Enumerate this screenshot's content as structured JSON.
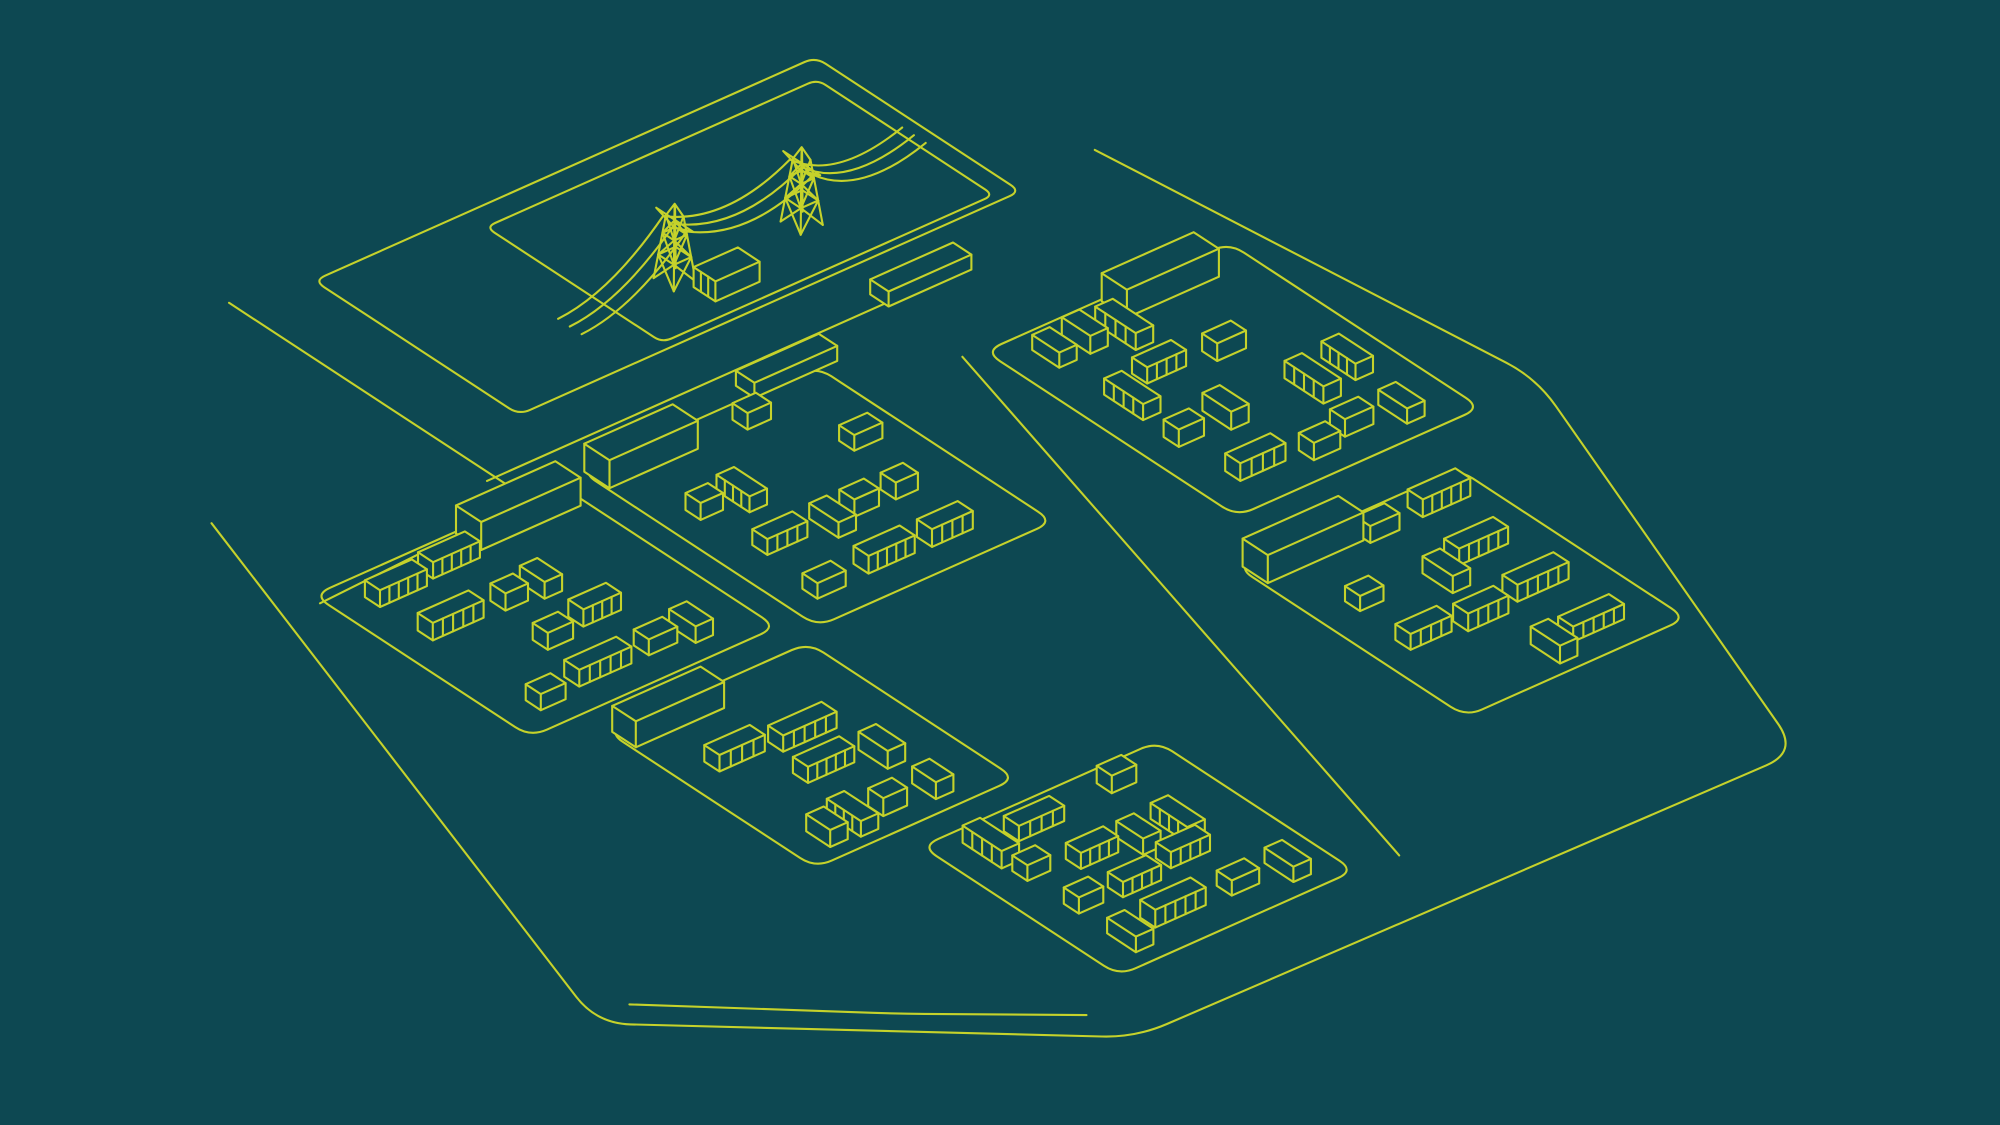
{
  "scene": {
    "width": 2000,
    "height": 1125,
    "background_color": "#0D4852",
    "line_color": "#C5D22B",
    "stroke_width": 2.1,
    "description": "Isometric line illustration of a housing development site with electricity pylons, substation, roads and six housing parcels"
  },
  "projection": {
    "e_axis": [
      0.92,
      -0.41
    ],
    "s_axis": [
      0.84,
      0.55
    ],
    "origin": [
      0,
      0
    ]
  },
  "site_boundary": {
    "points": [
      [
        -380,
        668
      ],
      [
        -625,
        1395
      ],
      [
        -290,
        1670
      ],
      [
        420,
        1680
      ],
      [
        620,
        1150
      ],
      [
        560,
        690
      ]
    ],
    "corner_radius": 34
  },
  "road_lines": [
    {
      "id": "main-road-lower-edge",
      "points": [
        [
          -151,
          438
        ],
        [
          -151,
          795
        ],
        [
          -389,
          807
        ]
      ],
      "corner_radius": 24
    },
    {
      "id": "collector-road-edge",
      "points": [
        [
          -160,
          755
        ],
        [
          345,
          755
        ]
      ],
      "corner_radius": 0
    },
    {
      "id": "central-road-east-edge",
      "points": [
        [
          270,
          850
        ],
        [
          60,
          1600
        ]
      ],
      "corner_radius": 0
    },
    {
      "id": "perimeter-road-inner-edge",
      "points": [
        [
          -585,
          1390
        ],
        [
          -420,
          1530
        ],
        [
          -300,
          1622
        ]
      ],
      "corner_radius": 26
    }
  ],
  "power_plot": {
    "outline": {
      "points": [
        [
          -74,
          455
        ],
        [
          471,
          455
        ],
        [
          471,
          699
        ],
        [
          -74,
          699
        ]
      ],
      "corner_radius": 12
    },
    "enclosure": {
      "points": [
        [
          90,
          480
        ],
        [
          450,
          480
        ],
        [
          450,
          690
        ],
        [
          90,
          690
        ]
      ],
      "corner_radius": 10
    },
    "pylons": [
      {
        "u": 160,
        "v": 628
      },
      {
        "u": 298,
        "v": 628
      }
    ],
    "wires": {
      "v_offsets": [
        -14,
        0,
        14
      ],
      "u_start": 46,
      "u_end": 420,
      "attach_height": 56
    },
    "substation": {
      "u": 165,
      "v": 645,
      "w": 48,
      "d": 26,
      "h": 20
    }
  },
  "garage_blocks": [
    {
      "u": 95,
      "v": 772,
      "w": 90,
      "d": 22,
      "h": 15
    },
    {
      "u": 272,
      "v": 738,
      "w": 90,
      "d": 22,
      "h": 15
    }
  ],
  "parcels": [
    {
      "id": "parcel-top-left",
      "plinth": [
        -385,
        795,
        268,
        258
      ],
      "corner_radius": 18,
      "long_building": [
        -232,
        797,
        108,
        30,
        28
      ],
      "seed": 11,
      "lanes": 4
    },
    {
      "id": "parcel-top-middle",
      "plinth": [
        -90,
        790,
        256,
        282
      ],
      "corner_radius": 18,
      "long_building": [
        -88,
        792,
        96,
        30,
        28
      ],
      "seed": 22,
      "lanes": 4
    },
    {
      "id": "parcel-top-right",
      "plinth": [
        290,
        855,
        265,
        300
      ],
      "corner_radius": 18,
      "long_building": [
        415,
        857,
        100,
        30,
        28
      ],
      "seed": 33,
      "lanes": 4
    },
    {
      "id": "parcel-bottom-left",
      "plinth": [
        -330,
        1085,
        218,
        247
      ],
      "corner_radius": 18,
      "long_building": [
        -327,
        1087,
        96,
        28,
        26
      ],
      "seed": 44,
      "lanes": 4
    },
    {
      "id": "parcel-bottom-middle",
      "plinth": [
        -240,
        1360,
        256,
        235
      ],
      "corner_radius": 18,
      "long_building": null,
      "seed": 55,
      "lanes": 4
    },
    {
      "id": "parcel-bottom-right",
      "plinth": [
        240,
        1210,
        240,
        272
      ],
      "corner_radius": 18,
      "long_building": [
        244,
        1212,
        104,
        30,
        28
      ],
      "seed": 66,
      "lanes": 4
    }
  ],
  "house_rules": {
    "margin": 22,
    "height_min": 15,
    "height_max": 18,
    "plain": {
      "w_min": 24,
      "w_max": 32,
      "depth": 18
    },
    "terrace": {
      "w_min": 40,
      "w_max": 58,
      "depth": 18,
      "stripe_pitch": 11
    },
    "rotated_plain": {
      "w": 19,
      "d_min": 26,
      "d_max": 36
    },
    "rotated_terrace": {
      "w": 19,
      "d_min": 38,
      "d_max": 50,
      "stripe_pitch": 11
    },
    "gap_min": 10,
    "gap_rand": 18,
    "skip_chance": 0.12
  },
  "pylon_style": {
    "base_half": 12,
    "top_half": 5,
    "body_height": 64,
    "apex_height": 76,
    "arm_height": 60,
    "arm_reach": 22,
    "belt_heights": [
      24,
      46
    ]
  }
}
